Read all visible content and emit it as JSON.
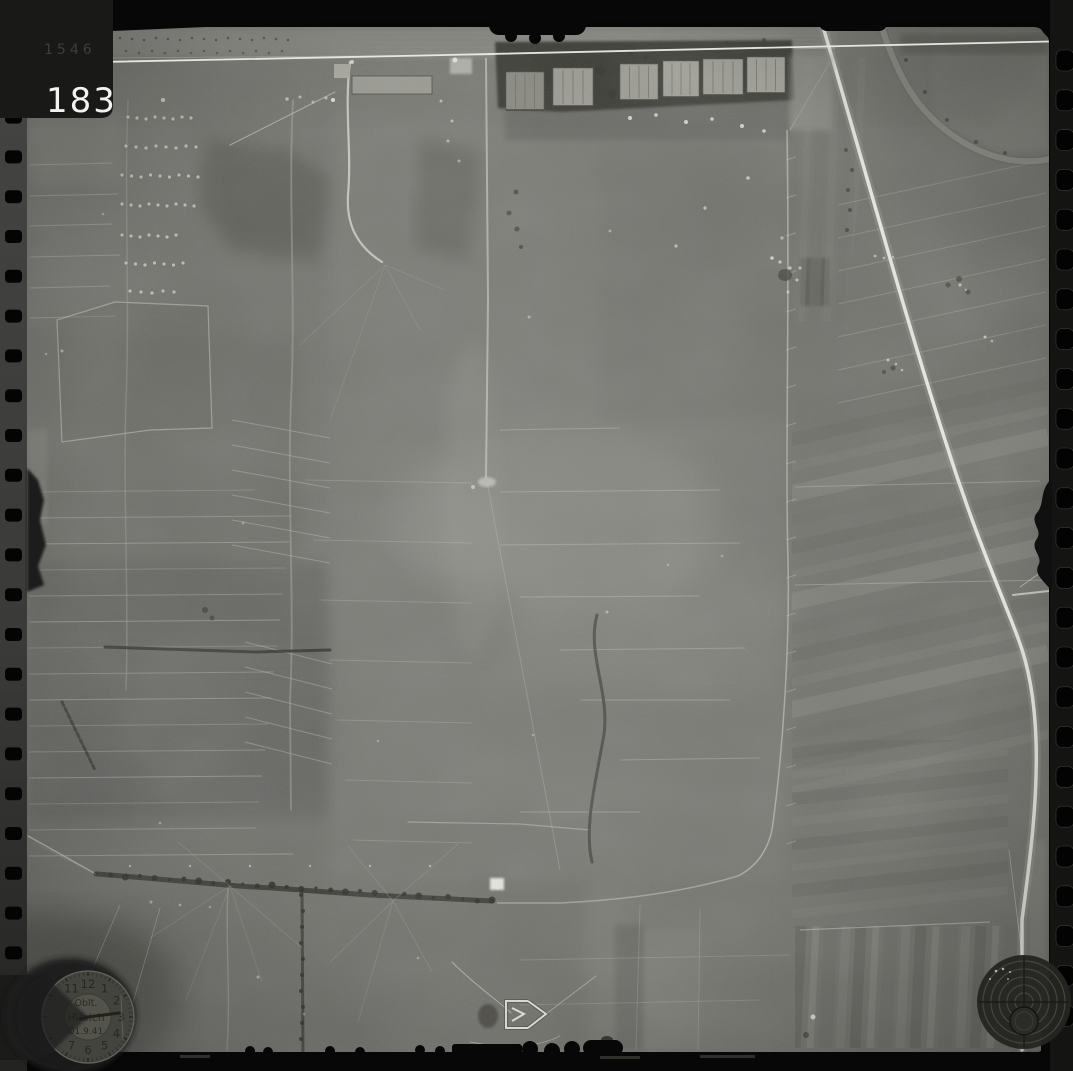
{
  "photo": {
    "frame_number": "183",
    "edge_number": "1546"
  },
  "clock_stamp": {
    "icon": "clock-dial-stamp",
    "numbers": [
      "11",
      "12",
      "1",
      "2",
      "3",
      "4",
      "5",
      "6",
      "7"
    ],
    "text_lines": [
      "Oblt.",
      "Hilbich",
      "01.9.41"
    ]
  },
  "reticle_stamp": {
    "icon": "concentric-circles-reticle-stamp"
  },
  "route_marker": {
    "icon": "arrow-route-marker"
  },
  "colors": {
    "film_black": "#060606",
    "film_strip_gray": "#3a3a38",
    "photo_mid_gray": "#787872",
    "highlight_white": "#efefe8",
    "shadow_gray": "#33332e"
  }
}
